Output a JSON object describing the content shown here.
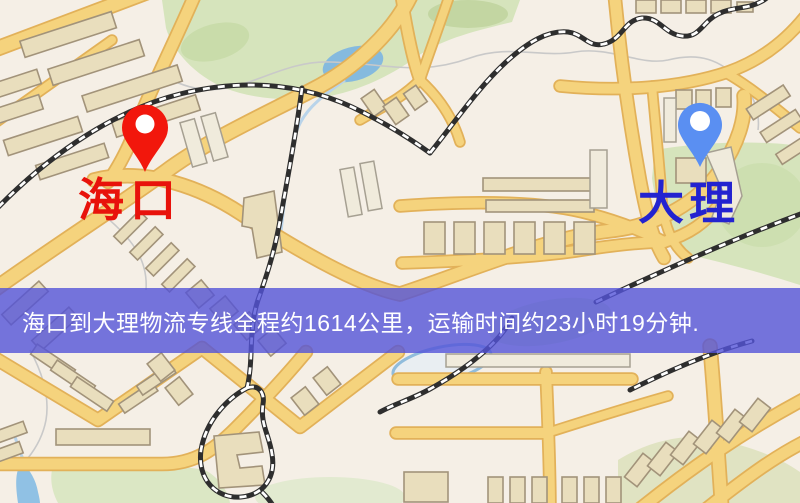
{
  "markers": {
    "origin": {
      "label": "海口",
      "pin_color": "#f2170c",
      "label_color": "#e8120b"
    },
    "destination": {
      "label": "大理",
      "pin_color": "#5a8ff2",
      "label_color": "#2323d0"
    }
  },
  "banner": {
    "text": "海口到大理物流专线全程约1614公里，运输时间约23小时19分钟.",
    "background_color": "#5454d8",
    "text_color": "#ffffff"
  },
  "route": {
    "origin": "海口",
    "destination": "大理",
    "distance_text": "约1614公里",
    "duration_text": "约23小时19分钟"
  },
  "map_colors": {
    "background": "#f5efe6",
    "road_fill": "#f5d37d",
    "road_casing": "#e2b159",
    "building": "#e9debd",
    "park": "#d6e4bc",
    "water": "#85bade",
    "railway": "#2e2e2e"
  }
}
